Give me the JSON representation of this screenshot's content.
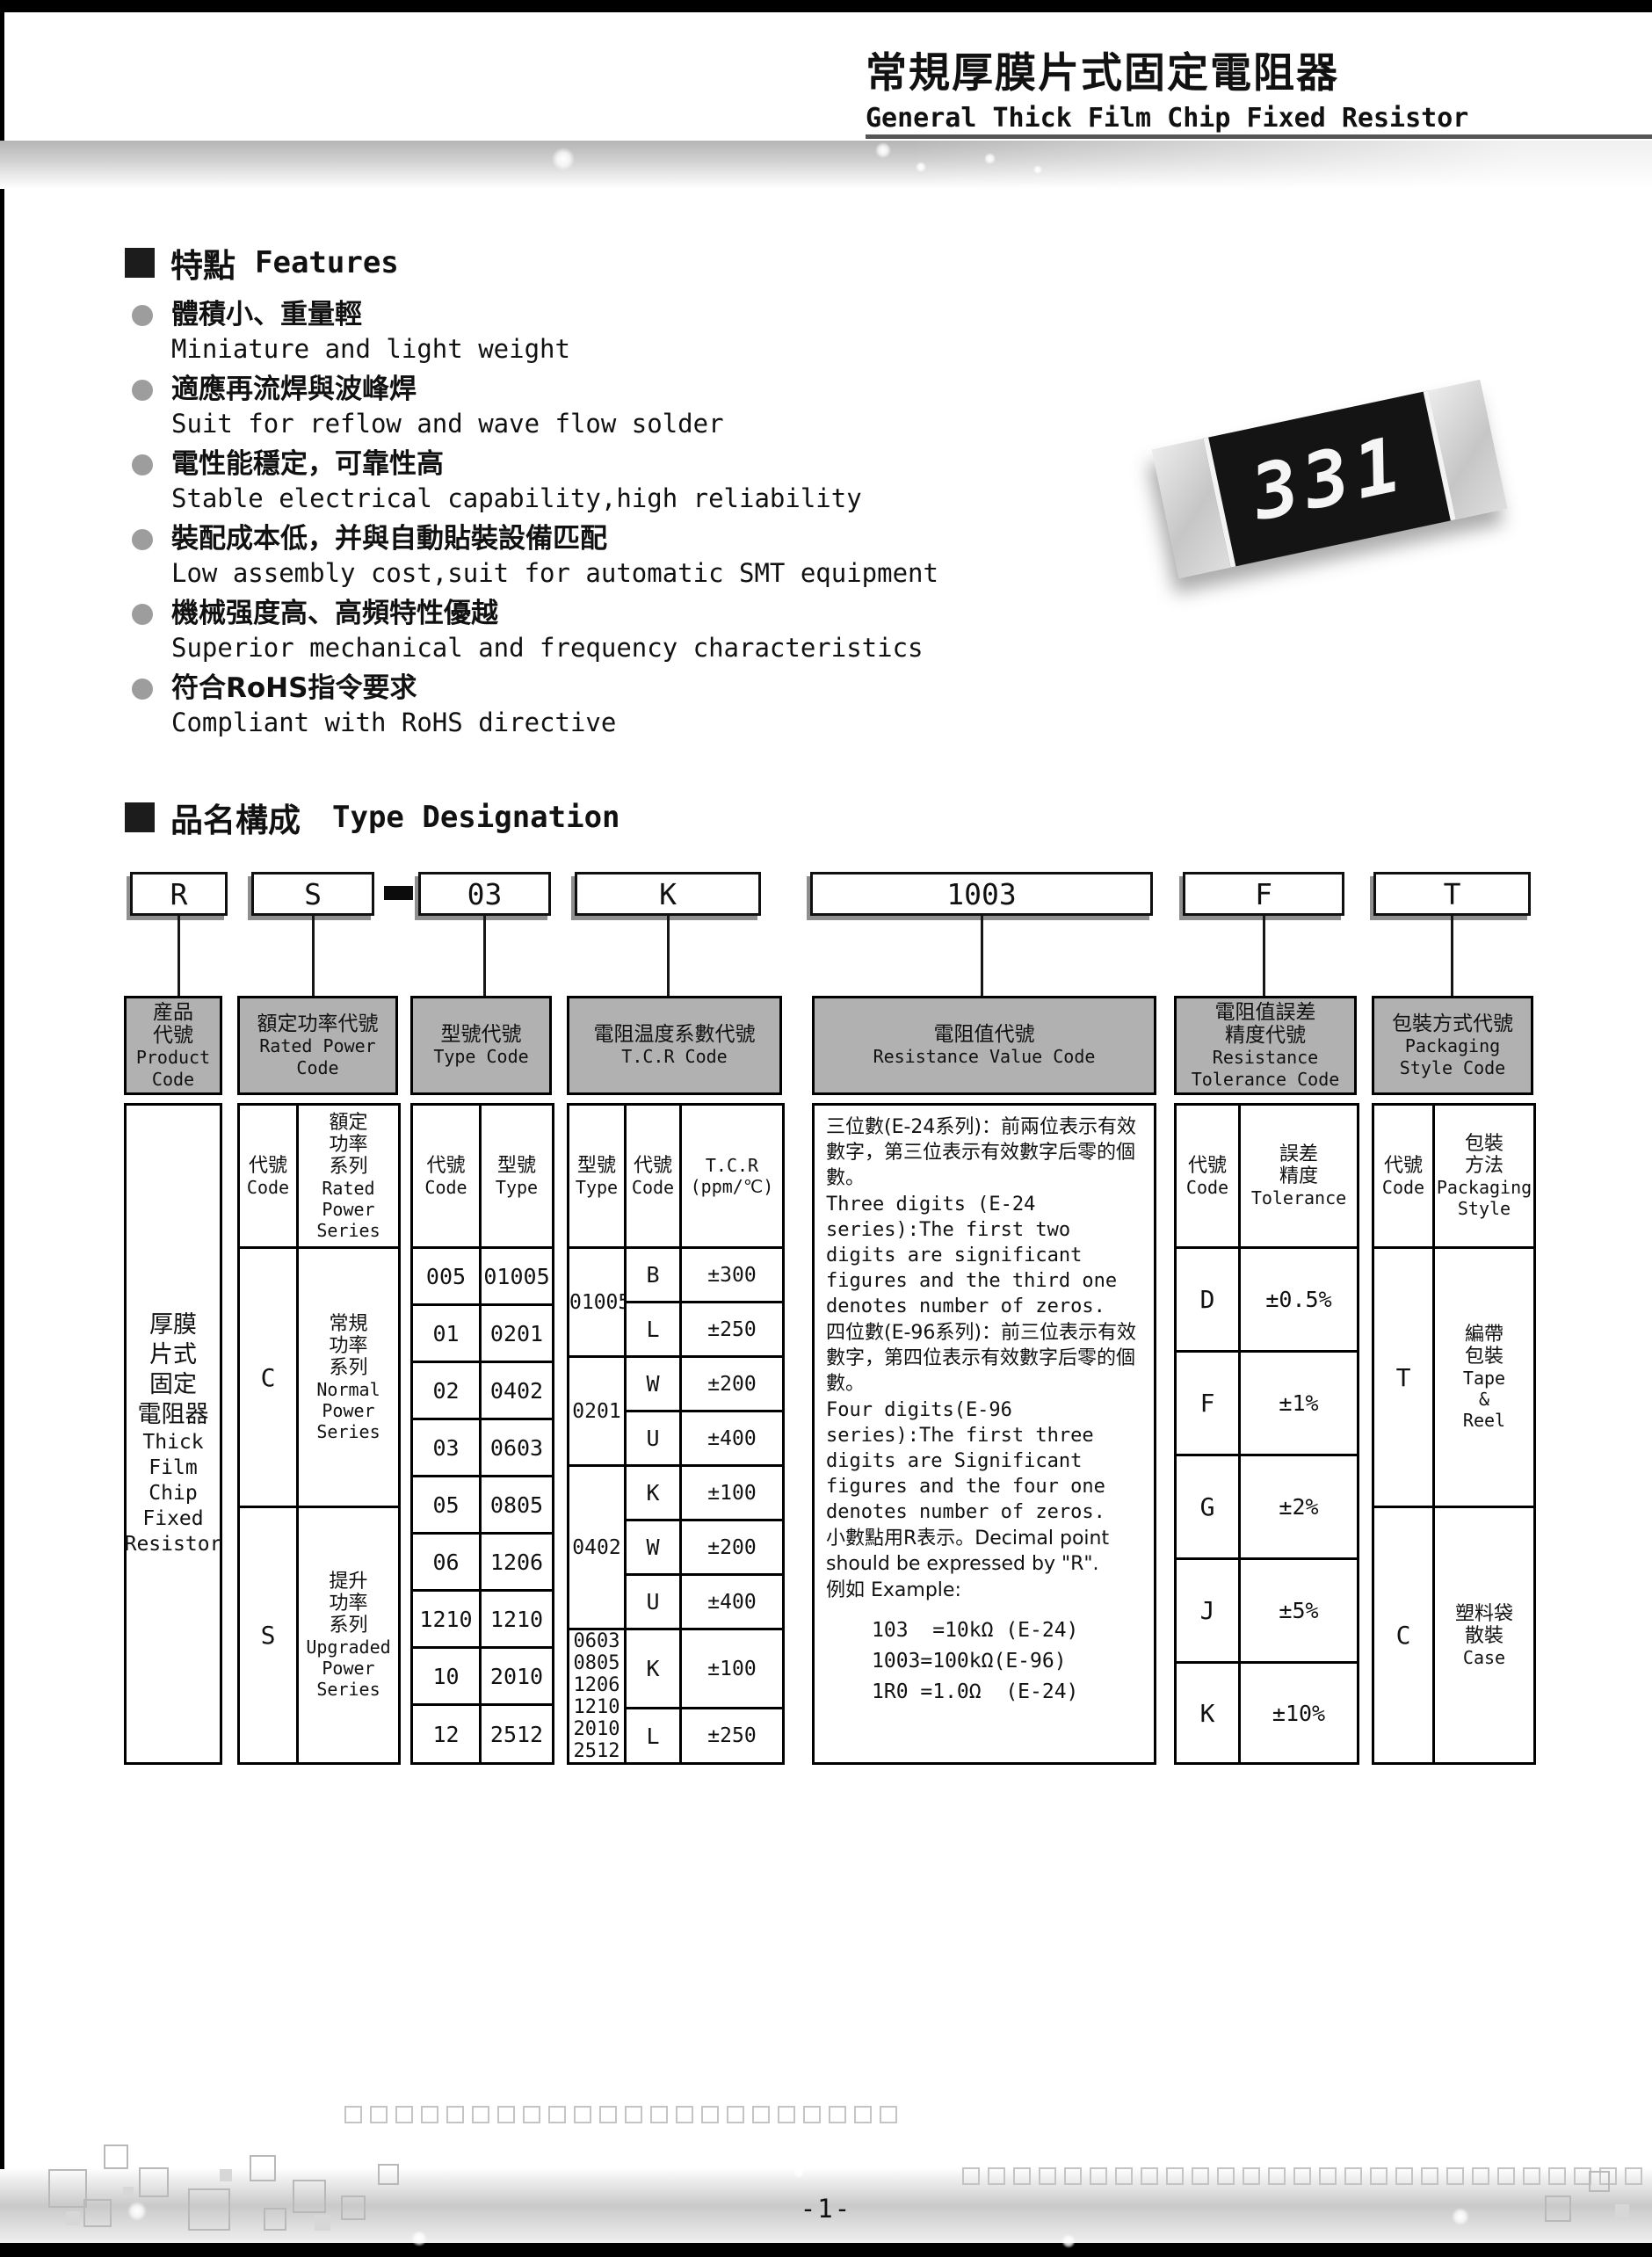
{
  "header": {
    "title_zh": "常規厚膜片式固定電阻器",
    "title_en": "General Thick Film Chip Fixed Resistor"
  },
  "features": {
    "heading_zh": "特點",
    "heading_en": "Features",
    "items": [
      {
        "zh": "體積小、重量輕",
        "en": "Miniature and light weight"
      },
      {
        "zh": "適應再流焊與波峰焊",
        "en": "Suit for reflow and wave flow solder"
      },
      {
        "zh": "電性能穩定，可靠性高",
        "en": "Stable electrical capability,high reliability"
      },
      {
        "zh": "裝配成本低，并與自動貼裝設備匹配",
        "en": "Low assembly cost,suit for automatic SMT equipment"
      },
      {
        "zh": "機械强度高、高頻特性優越",
        "en": "Superior mechanical and frequency characteristics"
      },
      {
        "zh": "符合RoHS指令要求",
        "en": "Compliant with RoHS directive"
      }
    ]
  },
  "resistor_photo": {
    "marking": "331"
  },
  "type_designation": {
    "heading_zh": "品名構成",
    "heading_en": "Type Designation",
    "code_boxes": [
      "R",
      "S",
      "03",
      "K",
      "1003",
      "F",
      "T"
    ],
    "separator": "-"
  },
  "columns": {
    "product": {
      "header": [
        "産品",
        "代號",
        "Product",
        "Code"
      ],
      "body": [
        "厚膜",
        "片式",
        "固定",
        "電阻器",
        "Thick",
        "Film",
        "Chip",
        "Fixed",
        "Resistor"
      ]
    },
    "power": {
      "header": [
        "額定功率代號",
        "Rated Power",
        "Code"
      ],
      "sub_code": [
        "代號",
        "Code"
      ],
      "sub_series": [
        "額定",
        "功率",
        "系列",
        "Rated",
        "Power",
        "Series"
      ],
      "rows": [
        {
          "code": "C",
          "series": [
            "常規",
            "功率",
            "系列",
            "Normal",
            "Power",
            "Series"
          ]
        },
        {
          "code": "S",
          "series": [
            "提升",
            "功率",
            "系列",
            "Upgraded",
            "Power",
            "Series"
          ]
        }
      ]
    },
    "type": {
      "header": [
        "型號代號",
        "Type Code"
      ],
      "sub_code": [
        "代號",
        "Code"
      ],
      "sub_type": [
        "型號",
        "Type"
      ],
      "rows": [
        [
          "005",
          "01005"
        ],
        [
          "01",
          "0201"
        ],
        [
          "02",
          "0402"
        ],
        [
          "03",
          "0603"
        ],
        [
          "05",
          "0805"
        ],
        [
          "06",
          "1206"
        ],
        [
          "1210",
          "1210"
        ],
        [
          "10",
          "2010"
        ],
        [
          "12",
          "2512"
        ]
      ]
    },
    "tcr": {
      "header": [
        "電阻温度系數代號",
        "T.C.R Code"
      ],
      "sub_type": [
        "型號",
        "Type"
      ],
      "sub_code": [
        "代號",
        "Code"
      ],
      "sub_tcr": [
        "T.C.R",
        "(ppm/℃)"
      ],
      "groups": [
        {
          "types": [
            "01005"
          ],
          "rows": [
            [
              "B",
              "±300"
            ],
            [
              "L",
              "±250"
            ]
          ]
        },
        {
          "types": [
            "0201"
          ],
          "rows": [
            [
              "W",
              "±200"
            ],
            [
              "U",
              "±400"
            ]
          ]
        },
        {
          "types": [
            "0402"
          ],
          "rows": [
            [
              "K",
              "±100"
            ],
            [
              "W",
              "±200"
            ],
            [
              "U",
              "±400"
            ]
          ]
        },
        {
          "types": [
            "0603",
            "0805",
            "1206",
            "1210",
            "2010",
            "2512"
          ],
          "rows": [
            [
              "K",
              "±100"
            ],
            [
              "L",
              "±250"
            ]
          ]
        }
      ]
    },
    "value": {
      "header": [
        "電阻值代號",
        "Resistance Value Code"
      ],
      "paragraphs": [
        "三位數(E-24系列)：前兩位表示有效數字，第三位表示有效數字后零的個數。",
        "Three digits (E-24 series):The first two digits are significant figures and the third one denotes number of zeros.",
        "四位數(E-96系列)：前三位表示有效數字，第四位表示有效數字后零的個數。",
        "Four digits(E-96 series):The first three digits are Significant figures and the four one denotes number of zeros.",
        "小數點用R表示。Decimal point should be expressed by \"R\".",
        "例如 Example:"
      ],
      "examples": [
        "103  =10kΩ (E-24)",
        "1003=100kΩ(E-96)",
        "1R0 =1.0Ω  (E-24)"
      ]
    },
    "tolerance": {
      "header": [
        "電阻值誤差",
        "精度代號",
        "Resistance",
        "Tolerance Code"
      ],
      "sub_code": [
        "代號",
        "Code"
      ],
      "sub_tol": [
        "誤差",
        "精度",
        "Tolerance"
      ],
      "rows": [
        [
          "D",
          "±0.5%"
        ],
        [
          "F",
          "±1%"
        ],
        [
          "G",
          "±2%"
        ],
        [
          "J",
          "±5%"
        ],
        [
          "K",
          "±10%"
        ]
      ]
    },
    "packaging": {
      "header": [
        "包裝方式代號",
        "Packaging",
        "Style Code"
      ],
      "sub_code": [
        "代號",
        "Code"
      ],
      "sub_style": [
        "包裝",
        "方法",
        "Packaging",
        "Style"
      ],
      "rows": [
        {
          "code": "T",
          "style": [
            "編帶",
            "包裝",
            "Tape",
            "&",
            "Reel"
          ]
        },
        {
          "code": "C",
          "style": [
            "塑料袋",
            "散裝",
            "Case"
          ]
        }
      ]
    }
  },
  "footer": {
    "page_number": "-1-"
  }
}
